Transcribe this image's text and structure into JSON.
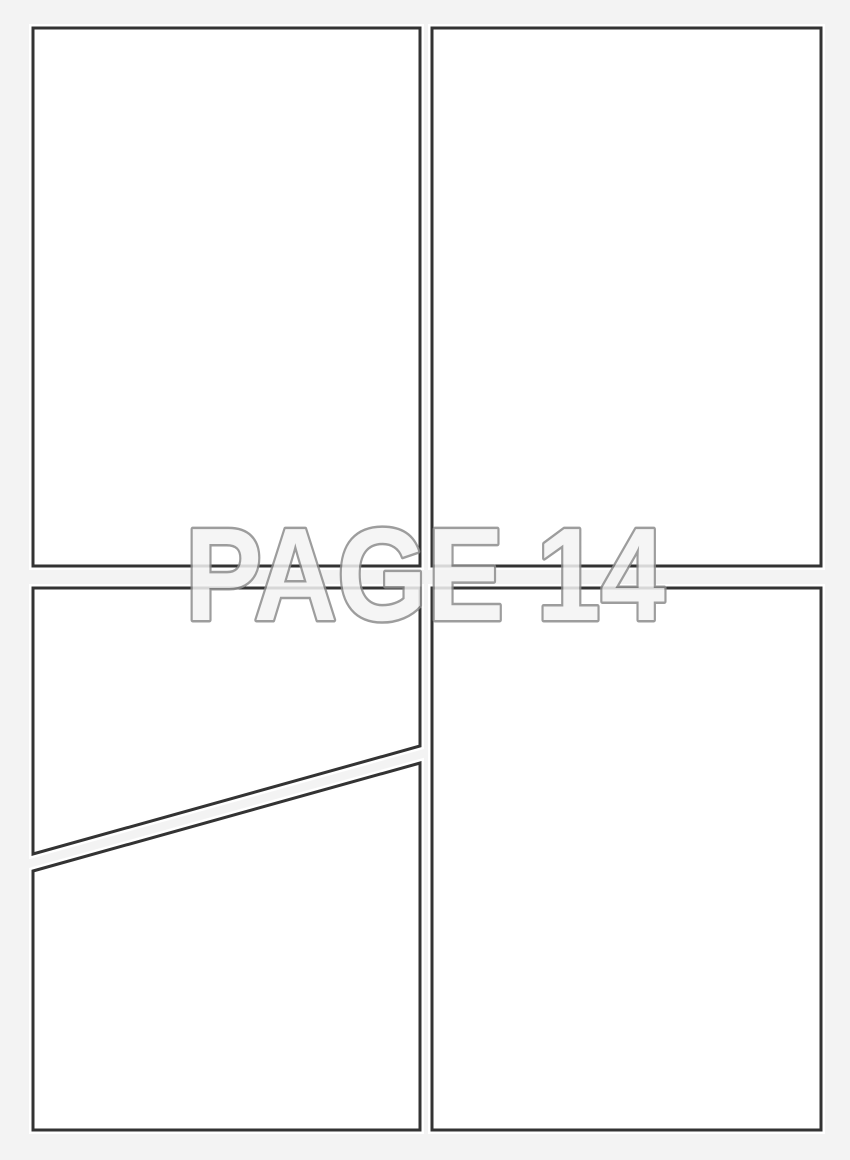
{
  "page": {
    "label": "PAGE 14",
    "number": "14"
  },
  "panels": {
    "count": 5,
    "names": [
      "panel-top-left",
      "panel-top-right",
      "panel-middle-left",
      "panel-bottom-left",
      "panel-bottom-right"
    ]
  },
  "colors": {
    "background": "#f3f3f3",
    "panel_fill": "#ffffff",
    "panel_border": "#333333",
    "label_fill": "#f4f4f4",
    "label_outline": "#8d8d8d"
  }
}
